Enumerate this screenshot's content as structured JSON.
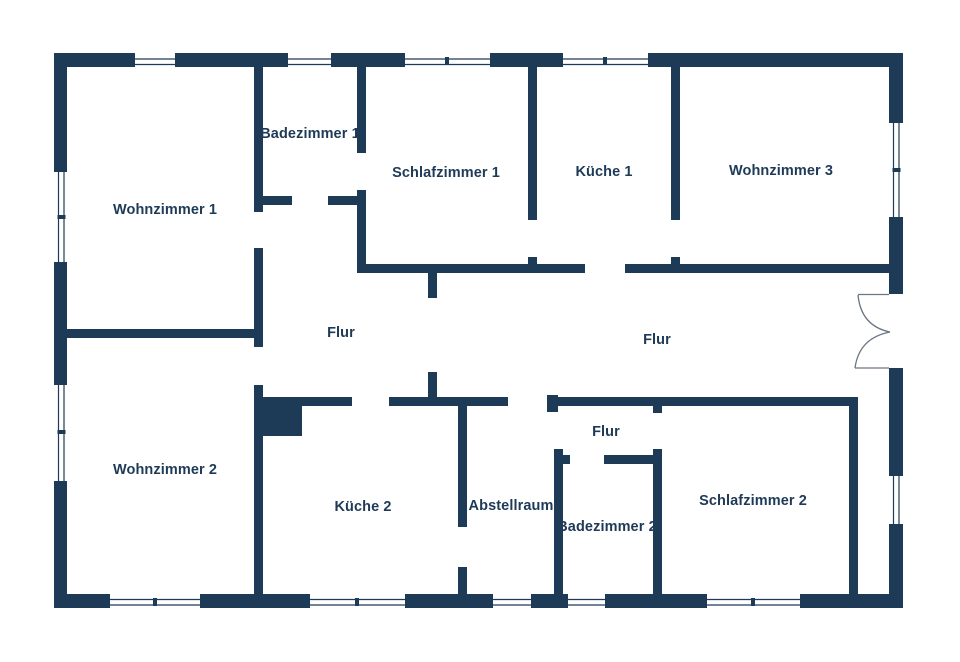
{
  "colors": {
    "wall": "#1d3a56",
    "label_text": "#1e3a57",
    "background": "#ffffff",
    "door_swing": "#6b7684",
    "window_line": "#1d3a56"
  },
  "rooms": [
    {
      "label": "Wohnzimmer 1"
    },
    {
      "label": "Badezimmer 1"
    },
    {
      "label": "Schlafzimmer 1"
    },
    {
      "label": "Küche 1"
    },
    {
      "label": "Wohnzimmer 3"
    },
    {
      "label": "Flur"
    },
    {
      "label": "Flur"
    },
    {
      "label": "Wohnzimmer 2"
    },
    {
      "label": "Küche 2"
    },
    {
      "label": "Abstellraum"
    },
    {
      "label": "Flur"
    },
    {
      "label": "Badezimmer 2"
    },
    {
      "label": "Schlafzimmer 2"
    }
  ]
}
